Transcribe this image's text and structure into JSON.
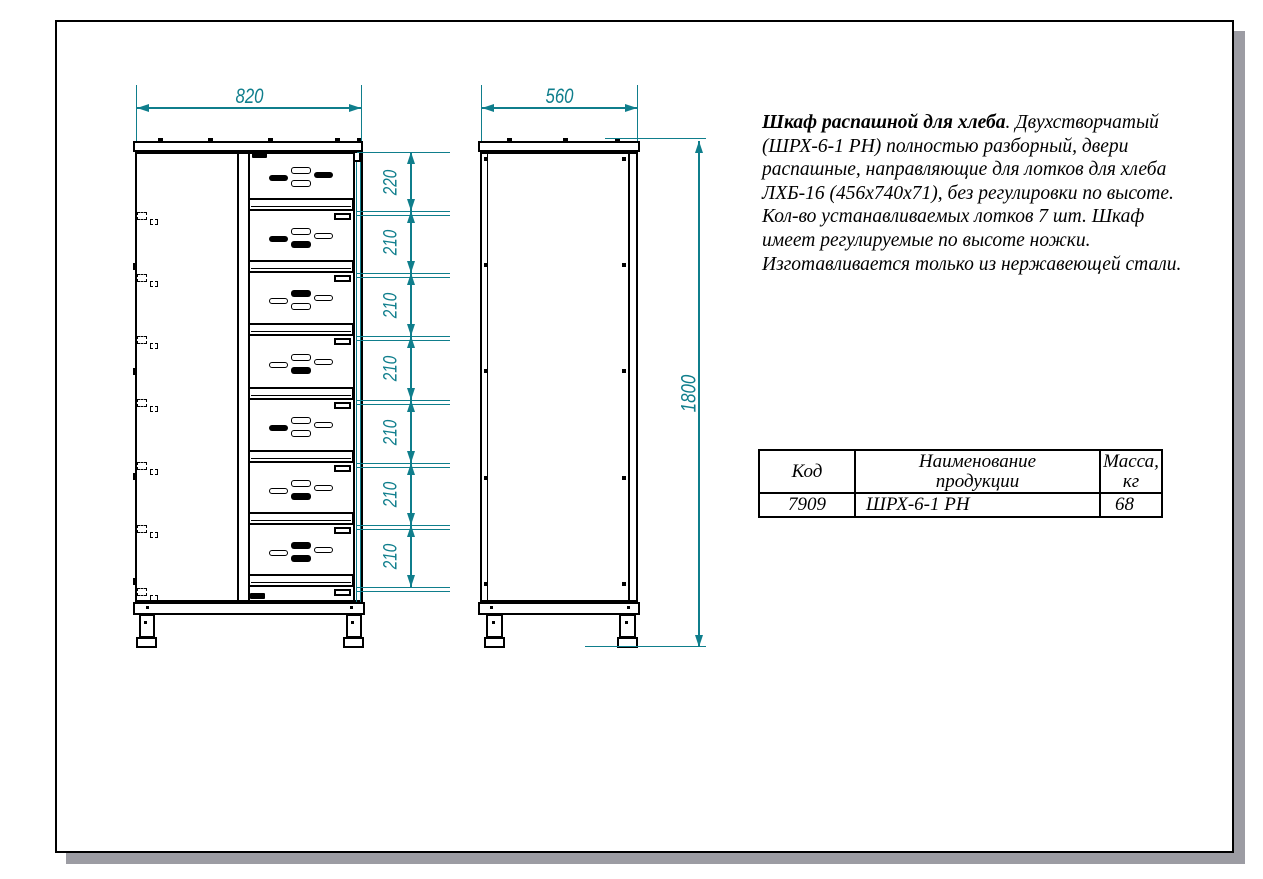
{
  "drawing": {
    "front_view": {
      "width_label": "820",
      "height_segments": [
        "220",
        "210",
        "210",
        "210",
        "210",
        "210",
        "210"
      ],
      "tray_count": 7,
      "tray_slot_patterns": [
        [
          "f",
          "o",
          "f",
          "o"
        ],
        [
          "f",
          "o",
          "o",
          "f"
        ],
        [
          "o",
          "f",
          "o",
          "o"
        ],
        [
          "o",
          "o",
          "o",
          "f"
        ],
        [
          "f",
          "o",
          "o",
          "o"
        ],
        [
          "o",
          "o",
          "o",
          "f"
        ],
        [
          "o",
          "f",
          "o",
          "f"
        ]
      ]
    },
    "side_view": {
      "width_label": "560",
      "height_label": "1800"
    }
  },
  "description": {
    "title": "Шкаф распашной для хлеба",
    "body": ". Двухстворчатый (ШРХ-6-1 РН) полностью разборный, двери распашные, направляющие для лотков для хлеба ЛХБ-16 (456х740х71), без регулировки по высоте. Кол-во устанавливаемых лотков 7 шт. Шкаф имеет регулируемые по высоте ножки. Изготавливается только из нержавеющей стали."
  },
  "table": {
    "headers": [
      "Код",
      "Наименование\nпродукции",
      "Масса,\nкг"
    ],
    "rows": [
      [
        "7909",
        "ШРХ-6-1 РН",
        "68"
      ]
    ]
  },
  "colors": {
    "dimension_teal": "#0f7e8c",
    "line_black": "#000000",
    "sheet_shadow": "#9c9ca3"
  }
}
